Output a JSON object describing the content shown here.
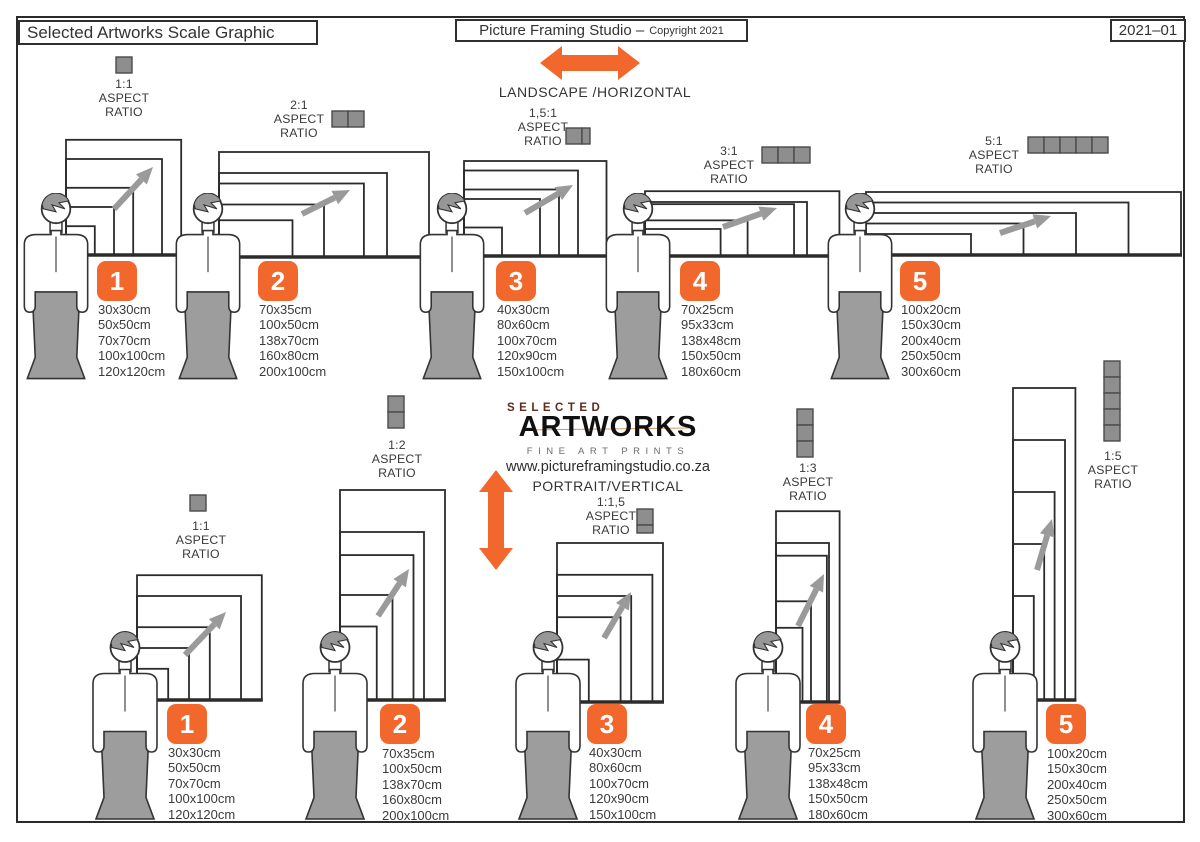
{
  "header": {
    "title": "Selected Artworks Scale Graphic",
    "studio_name": "Picture Framing Studio –",
    "copyright": "Copyright 2021",
    "edition_code": "2021–01"
  },
  "sections": {
    "landscape_label": "LANDSCAPE /HORIZONTAL",
    "portrait_label": "PORTRAIT/VERTICAL"
  },
  "logo": {
    "line1": "SELECTED",
    "line2": "ARTWORKS",
    "line3": "FINE ART PRINTS",
    "website": "www.pictureframingstudio.co.za"
  },
  "aspect_words": [
    "ASPECT",
    "RATIO"
  ],
  "colors": {
    "accent_orange": "#F2672B",
    "figure_gray": "#9B9B9B",
    "icon_gray": "#8E8E8E",
    "arrow_gray": "#9A9A9A",
    "line_dark": "#2B2B2B"
  },
  "groups": [
    {
      "id": 1,
      "orientation": "landscape",
      "ratio": "1:1",
      "sizes": [
        "30x30cm",
        "50x50cm",
        "70x70cm",
        "100x100cm",
        "120x120cm"
      ]
    },
    {
      "id": 2,
      "orientation": "landscape",
      "ratio": "2:1",
      "sizes": [
        "70x35cm",
        "100x50cm",
        "138x70cm",
        "160x80cm",
        "200x100cm"
      ]
    },
    {
      "id": 3,
      "orientation": "landscape",
      "ratio": "1,5:1",
      "sizes": [
        "40x30cm",
        "80x60cm",
        "100x70cm",
        "120x90cm",
        "150x100cm"
      ]
    },
    {
      "id": 4,
      "orientation": "landscape",
      "ratio": "3:1",
      "sizes": [
        "70x25cm",
        "95x33cm",
        "138x48cm",
        "150x50cm",
        "180x60cm"
      ]
    },
    {
      "id": 5,
      "orientation": "landscape",
      "ratio": "5:1",
      "sizes": [
        "100x20cm",
        "150x30cm",
        "200x40cm",
        "250x50cm",
        "300x60cm"
      ]
    },
    {
      "id": 1,
      "orientation": "portrait",
      "ratio": "1:1",
      "sizes": [
        "30x30cm",
        "50x50cm",
        "70x70cm",
        "100x100cm",
        "120x120cm"
      ]
    },
    {
      "id": 2,
      "orientation": "portrait",
      "ratio": "1:2",
      "sizes": [
        "70x35cm",
        "100x50cm",
        "138x70cm",
        "160x80cm",
        "200x100cm"
      ]
    },
    {
      "id": 3,
      "orientation": "portrait",
      "ratio": "1:1,5",
      "sizes": [
        "40x30cm",
        "80x60cm",
        "100x70cm",
        "120x90cm",
        "150x100cm"
      ]
    },
    {
      "id": 4,
      "orientation": "portrait",
      "ratio": "1:3",
      "sizes": [
        "70x25cm",
        "95x33cm",
        "138x48cm",
        "150x50cm",
        "180x60cm"
      ]
    },
    {
      "id": 5,
      "orientation": "portrait",
      "ratio": "1:5",
      "sizes": [
        "100x20cm",
        "150x30cm",
        "200x40cm",
        "250x50cm",
        "300x60cm"
      ]
    }
  ]
}
